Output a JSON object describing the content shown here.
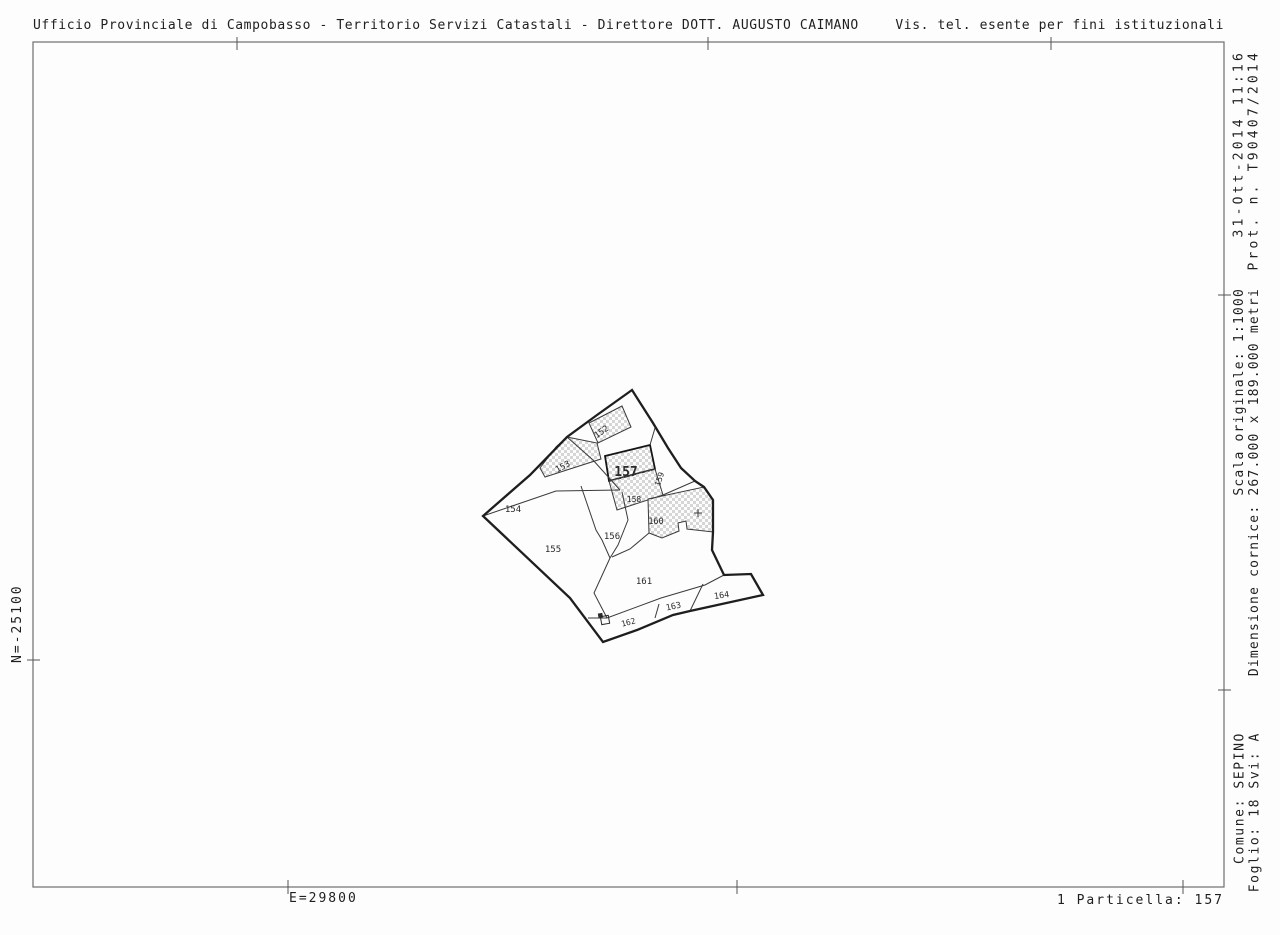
{
  "header": {
    "left": "Ufficio Provinciale di Campobasso - Territorio Servizi Catastali - Direttore DOTT. AUGUSTO CAIMANO",
    "right": "Vis. tel. esente per fini istituzionali"
  },
  "margin_right": {
    "top": {
      "line1": "31-Ott-2014 11:16",
      "line2": "Prot. n. T90407/2014"
    },
    "middle": {
      "line1": "Scala originale: 1:1000",
      "line2": "Dimensione cornice: 267.000 x 189.000 metri"
    },
    "bottom": {
      "line1": "Comune: SEPINO",
      "line2": "Foglio: 18 Svi: A"
    }
  },
  "coordinates": {
    "north": "N=-25100",
    "east": "E=29800"
  },
  "footer": {
    "particella": "1 Particella: 157"
  },
  "map": {
    "subject_parcel": "157",
    "symbol": {
      "name": "well-symbol"
    },
    "parcels": [
      {
        "label": "152",
        "hatched": true
      },
      {
        "label": "153",
        "hatched": true
      },
      {
        "label": "154",
        "hatched": false
      },
      {
        "label": "155",
        "hatched": false
      },
      {
        "label": "156",
        "hatched": false
      },
      {
        "label": "157",
        "hatched": true
      },
      {
        "label": "158",
        "hatched": true
      },
      {
        "label": "159",
        "hatched": false
      },
      {
        "label": "160",
        "hatched": true
      },
      {
        "label": "161",
        "hatched": false
      },
      {
        "label": "162",
        "hatched": false
      },
      {
        "label": "163",
        "hatched": false
      },
      {
        "label": "164",
        "hatched": false
      }
    ],
    "colors": {
      "boundary": "#1e1e1e",
      "thin_line": "#3a3a3a",
      "hatch": "#d6d6d6",
      "frame": "#6e6e6e",
      "text": "#1f1f1f"
    }
  }
}
